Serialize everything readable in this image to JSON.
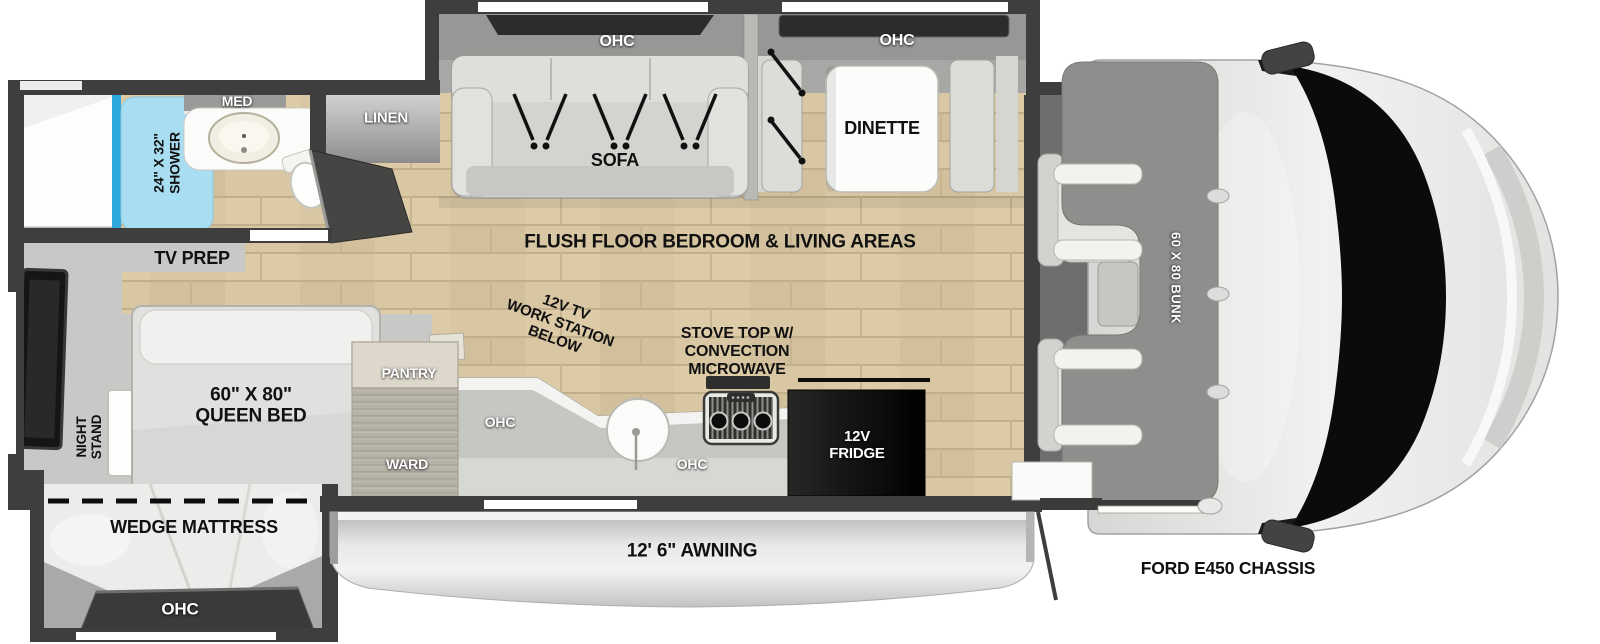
{
  "floorplan": {
    "living": {
      "flush_floor": "FLUSH FLOOR BEDROOM & LIVING AREAS",
      "sofa": "SOFA",
      "sofa_ohc": "OHC",
      "dinette": "DINETTE",
      "dinette_ohc": "OHC"
    },
    "bathroom": {
      "shower": "24\" X 32\"\nSHOWER",
      "med_cabinet": "MED",
      "linen": "LINEN"
    },
    "bedroom": {
      "tv_prep": "TV PREP",
      "night_stand": "NIGHT\nSTAND",
      "queen_bed": "60\" X 80\"\nQUEEN BED",
      "wedge_mattress": "WEDGE MATTRESS",
      "wedge_ohc": "OHC"
    },
    "kitchen": {
      "work_station": "12V TV\nWORK STATION\nBELOW",
      "stove": "STOVE TOP W/\nCONVECTION\nMICROWAVE",
      "pantry": "PANTRY",
      "wardrobe": "WARD",
      "ohc_upper": "OHC",
      "ohc_lower": "OHC",
      "fridge": "12V\nFRIDGE"
    },
    "exterior": {
      "awning": "12' 6\" AWNING",
      "chassis": "FORD E450 CHASSIS"
    },
    "cab": {
      "bunk": "60 X 80 BUNK"
    },
    "colors": {
      "wall": "#3e3e3e",
      "wood_floor": "#d9c7a3",
      "shower_blue": "#a9ddf1",
      "shower_accent": "#2fa8dc",
      "fridge": "#0d0d0d",
      "slide_interior": "#a7a7a5",
      "label_white": "#ffffff",
      "label_black": "#111111"
    }
  }
}
